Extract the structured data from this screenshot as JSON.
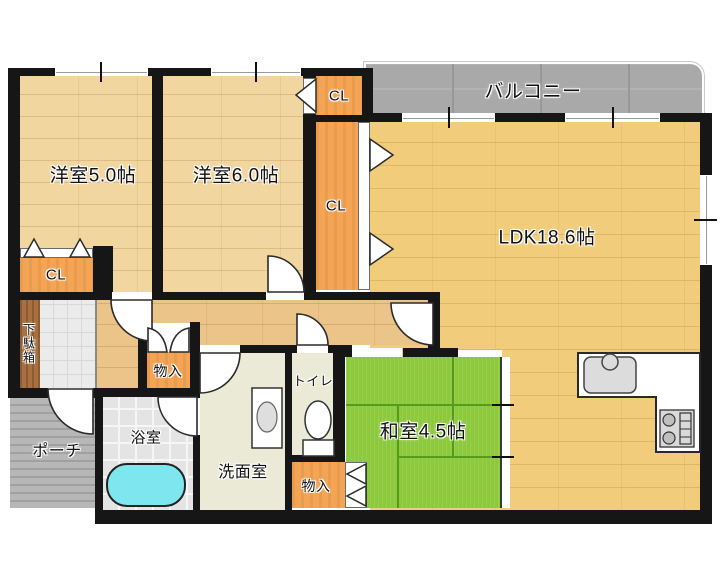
{
  "plan": {
    "title": "2LDK floor plan",
    "balcony": "バルコニー",
    "porch": "ポーチ",
    "shoe_cabinet": "下駄箱",
    "bathroom": "浴室",
    "washroom": "洗面室",
    "toilet": "トイレ",
    "closet": "CL",
    "storage": "物入",
    "western_room_5": "洋室5.0帖",
    "western_room_6": "洋室6.0帖",
    "japanese_room": "和室4.5帖",
    "ldk": "LDK18.6帖"
  },
  "colors": {
    "wall": "#161616",
    "western_room_floor": "#f1d6a0",
    "ldk_floor": "#f1cd7b",
    "hall_floor": "#eac488",
    "closet_orange": "#f4a453",
    "tatami_green": "#8cc93c",
    "balcony_gray": "#a9a9a9",
    "porch_gray": "#b7b7b7",
    "bathtub_cyan": "#7ee6ef",
    "shoe_cabinet_brown": "#a87040",
    "wet_area_floor": "#ebead6"
  }
}
